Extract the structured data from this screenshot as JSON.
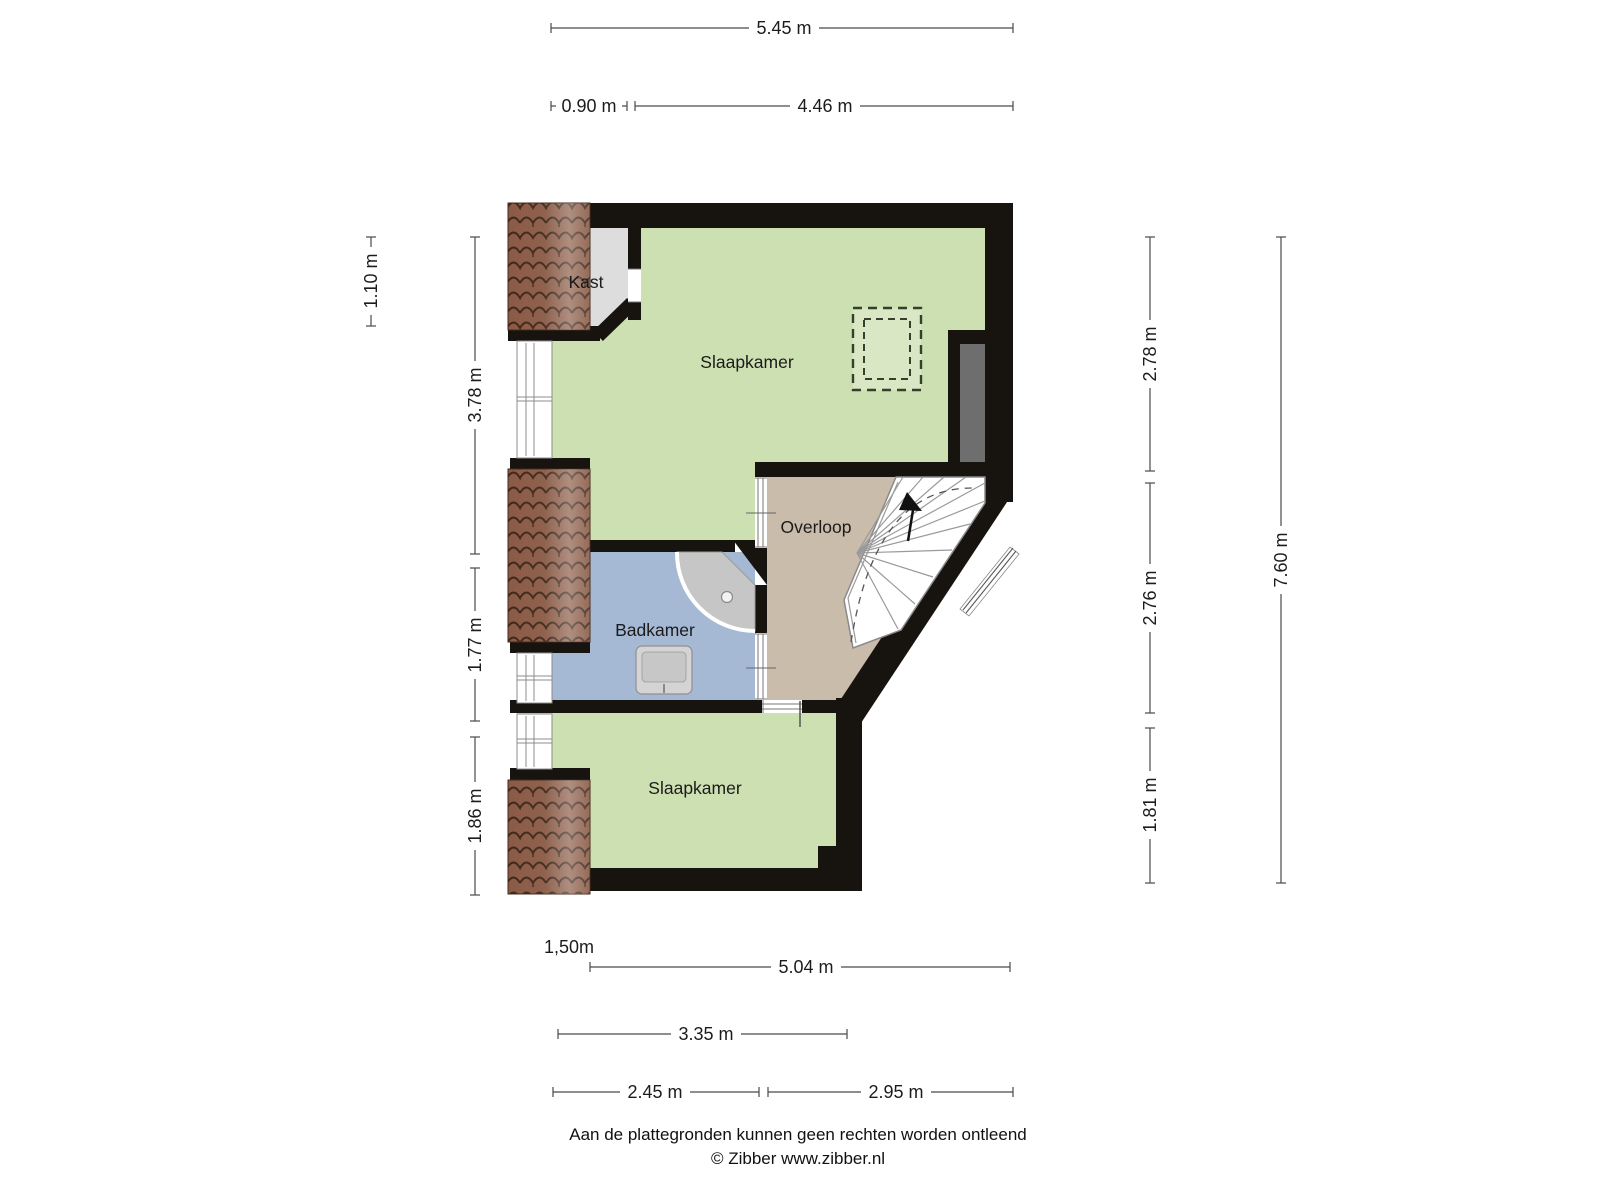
{
  "floorplan": {
    "rooms": {
      "kast": "Kast",
      "slaapkamer_top": "Slaapkamer",
      "overloop": "Overloop",
      "badkamer": "Badkamer",
      "slaapkamer_bottom": "Slaapkamer"
    },
    "dimensions": {
      "top_total": "5.45 m",
      "top_kast": "0.90 m",
      "top_room": "4.46 m",
      "left_roof": "1.10 m",
      "left_top": "3.78 m",
      "left_mid": "1.77 m",
      "left_bottom": "1.86 m",
      "right_top": "2.78 m",
      "right_mid": "2.76 m",
      "right_bottom": "1.81 m",
      "right_total": "7.60 m",
      "headroom": "1,50m",
      "bottom_total": "5.04 m",
      "bottom_span": "3.35 m",
      "bottom_left": "2.45 m",
      "bottom_right": "2.95 m"
    },
    "colors": {
      "wall": "#17130f",
      "room_green": "#cde0b2",
      "room_tan": "#c9bcab",
      "room_blue": "#a5b9d5",
      "room_gray": "#dddddd",
      "void_gray": "#6e6e6e",
      "roof_tile": "#8a5a45",
      "skylight_fill": "#d9e7c5"
    }
  },
  "footer": {
    "disclaimer": "Aan de plattegronden kunnen geen rechten worden ontleend",
    "credit": "© Zibber www.zibber.nl"
  }
}
